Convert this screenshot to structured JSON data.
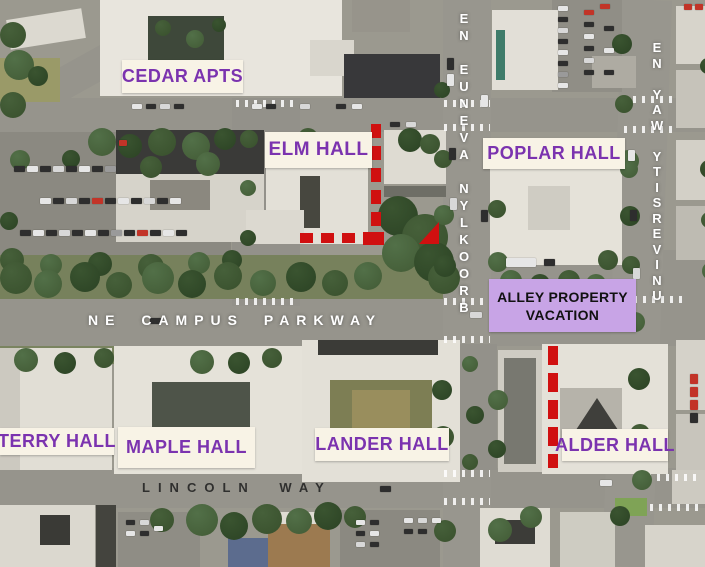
{
  "labels": {
    "cedar": "CEDAR APTS",
    "elm": "ELM HALL",
    "poplar": "POPLAR HALL",
    "terry": "TERRY HALL",
    "maple": "MAPLE HALL",
    "lander": "LANDER HALL",
    "alder": "ALDER HALL"
  },
  "streets": {
    "brooklyn": "BROOKLYN AVENUE NE",
    "university": "UNIVERSITY WAY NE",
    "campus_parkway": "NE CAMPUS PARKWAY",
    "lincoln": "LINCOLN WAY"
  },
  "callout": {
    "line1": "ALLEY PROPERTY",
    "line2": "VACATION"
  },
  "colors": {
    "label_box_bg": "#f8f3e6",
    "label_text": "#7b33af",
    "callout_bg": "#c8a4e6",
    "callout_text": "#111111",
    "marker_red": "#d01010",
    "street_text_light": "#ffffff",
    "street_text_dark": "#1e1e1e"
  }
}
